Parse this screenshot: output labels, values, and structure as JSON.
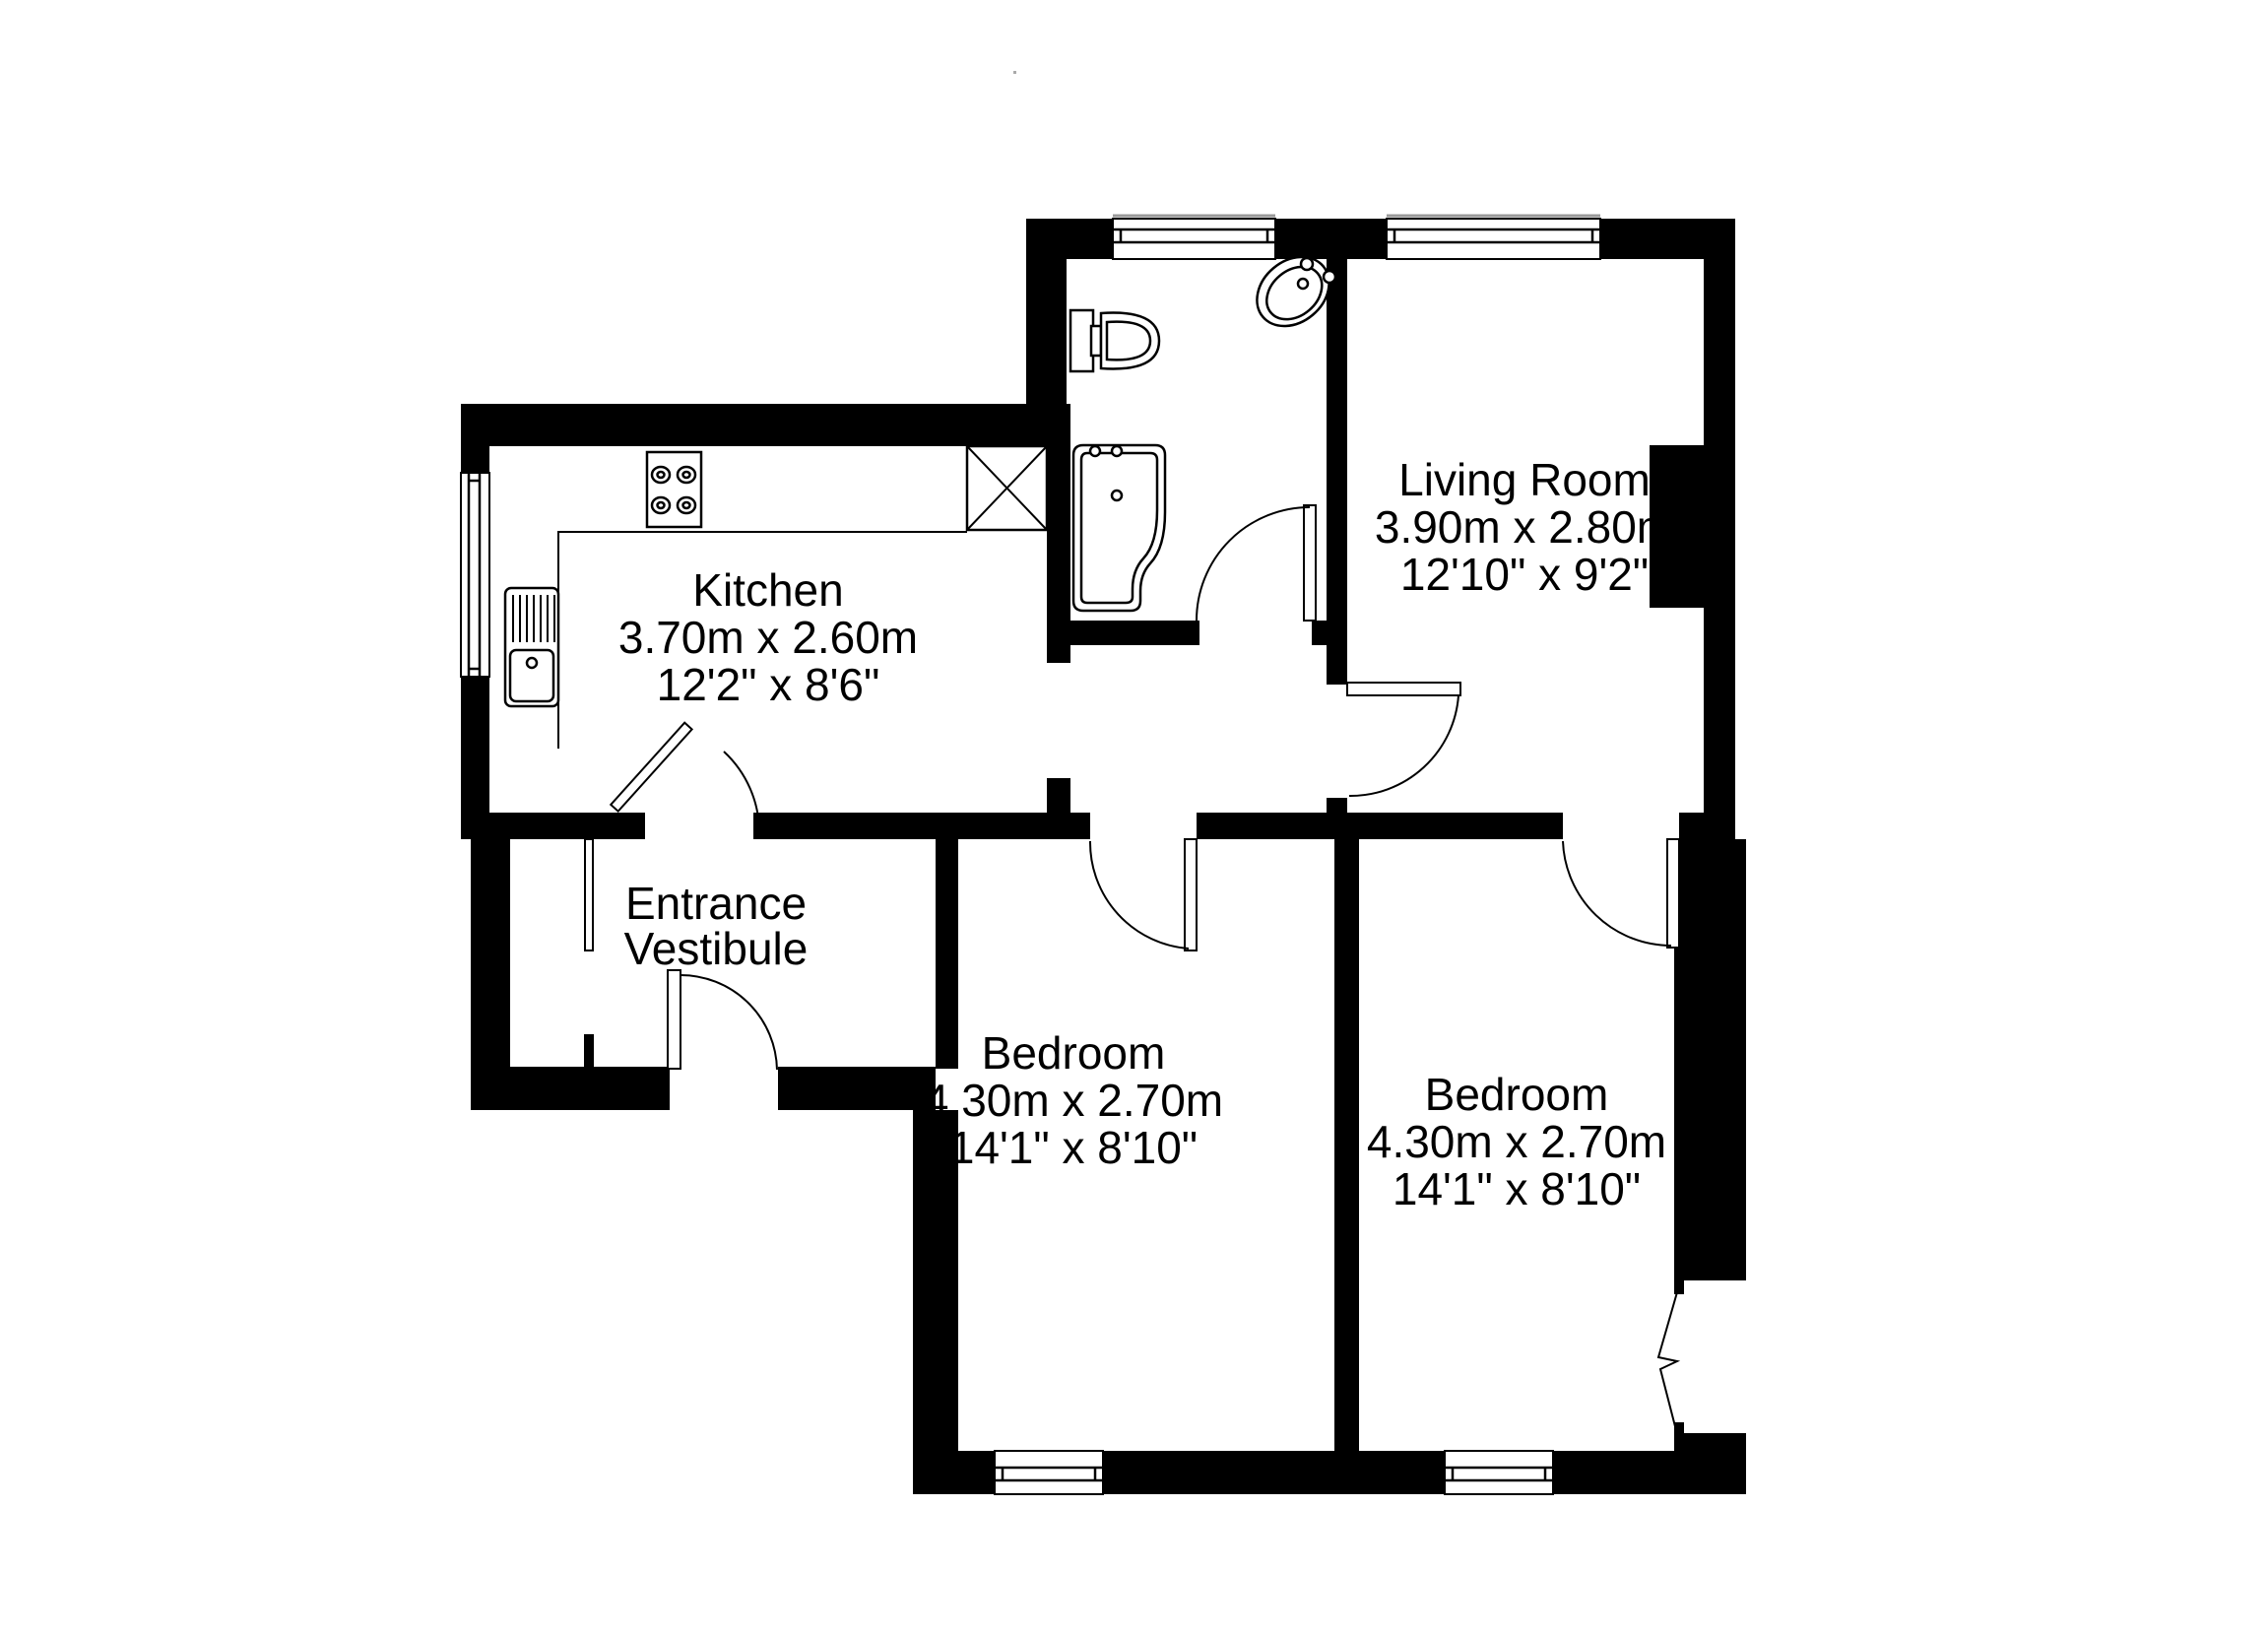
{
  "plan": {
    "rooms": {
      "kitchen": {
        "name": "Kitchen",
        "metric": "3.70m x 2.60m",
        "imperial": "12'2\" x 8'6\""
      },
      "living_room": {
        "name": "Living Room",
        "metric": "3.90m x 2.80m",
        "imperial": "12'10\" x 9'2\""
      },
      "entrance_vestibule": {
        "line1": "Entrance",
        "line2": "Vestibule"
      },
      "bedroom_1": {
        "name": "Bedroom",
        "metric": "4.30m x 2.70m",
        "imperial": "14'1\" x 8'10\""
      },
      "bedroom_2": {
        "name": "Bedroom",
        "metric": "4.30m x 2.70m",
        "imperial": "14'1\" x 8'10\""
      }
    },
    "fixtures": [
      "toilet",
      "wash-basin",
      "bathtub",
      "kitchen-sink",
      "stove",
      "kitchen-unit"
    ],
    "colors": {
      "wall": "#000000",
      "background": "#ffffff",
      "outline": "#000000",
      "sill": "#999999"
    }
  }
}
